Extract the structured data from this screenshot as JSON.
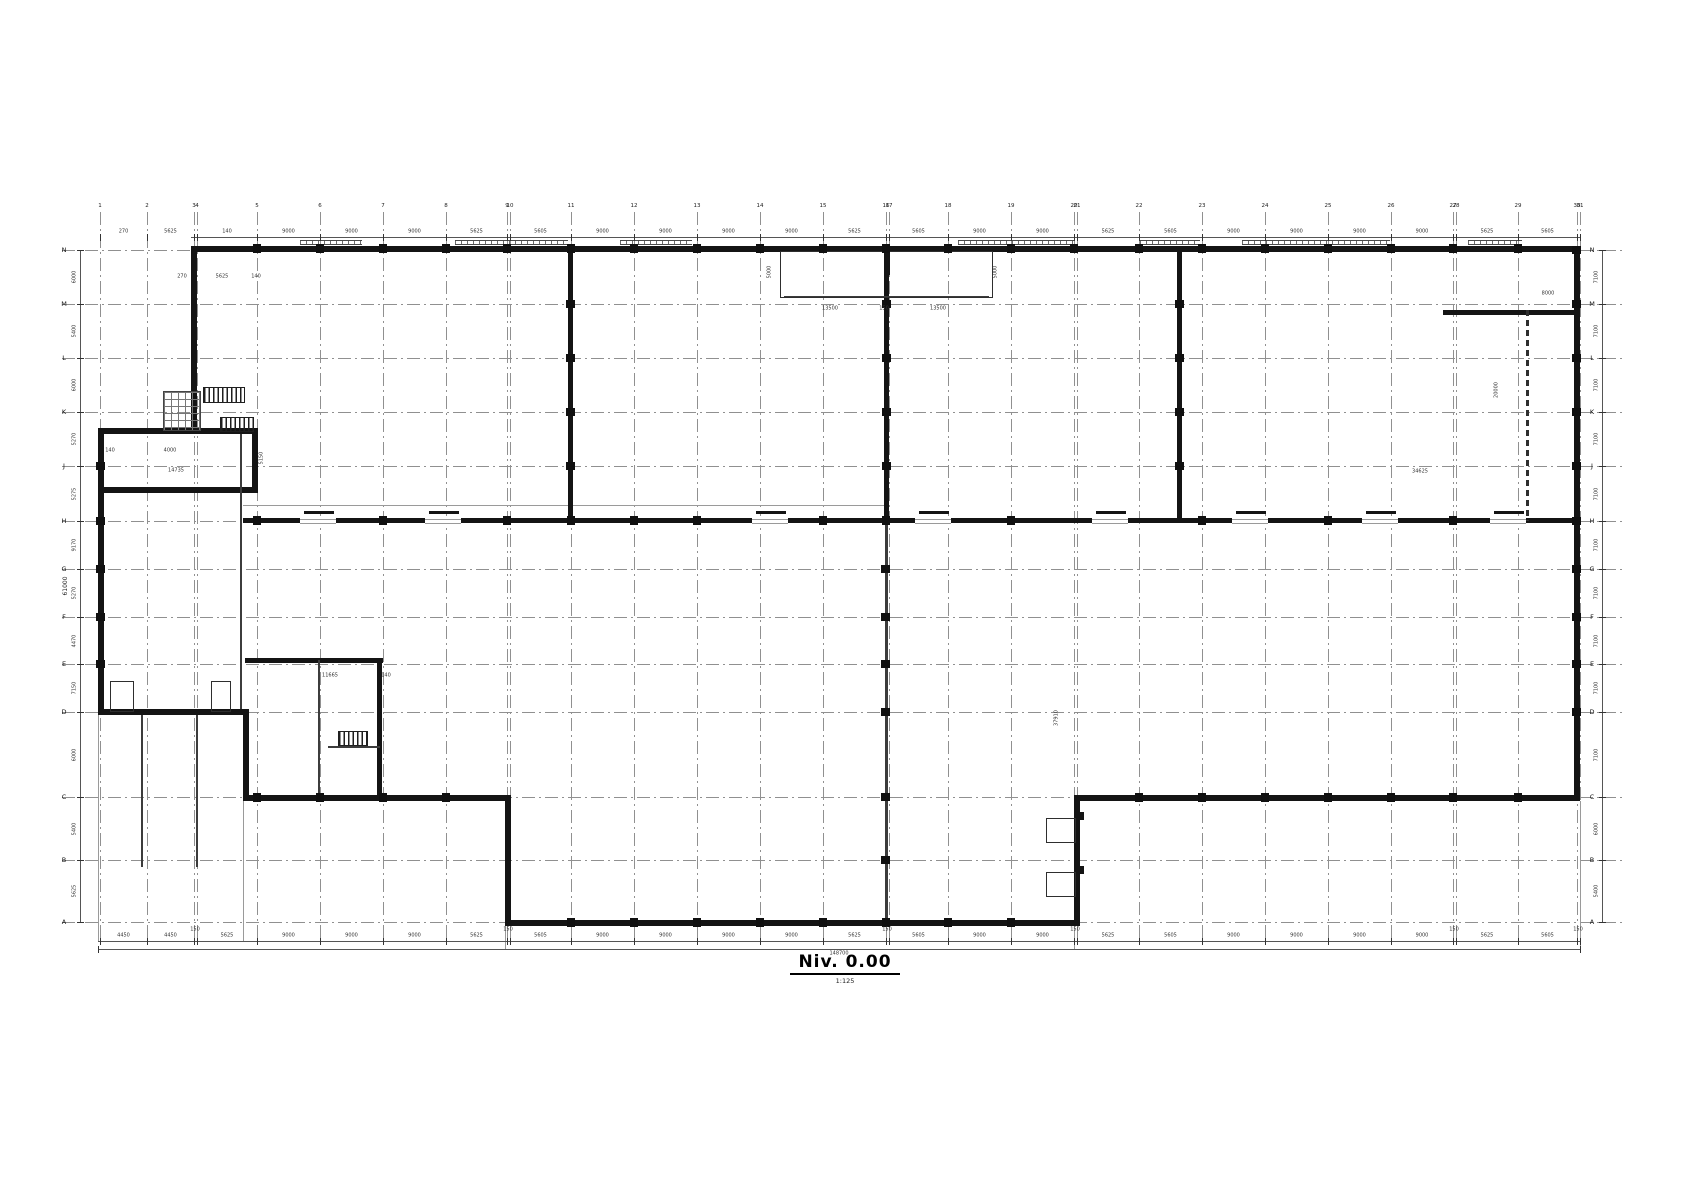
{
  "sheet": {
    "title": "Niv. 0.00",
    "scale": "1:125"
  },
  "colors": {
    "wall": "#141414",
    "grid": "#909090",
    "dim": "#2b2b2b",
    "window": "#6a6a6a"
  },
  "grid": {
    "columns": [
      {
        "label": "1",
        "x": 100
      },
      {
        "label": "2",
        "x": 147
      },
      {
        "label": "3",
        "x": 194
      },
      {
        "label": "4",
        "x": 197
      },
      {
        "label": "5",
        "x": 257
      },
      {
        "label": "6",
        "x": 320
      },
      {
        "label": "7",
        "x": 383
      },
      {
        "label": "8",
        "x": 446
      },
      {
        "label": "9",
        "x": 507
      },
      {
        "label": "10",
        "x": 510
      },
      {
        "label": "11",
        "x": 571
      },
      {
        "label": "12",
        "x": 634
      },
      {
        "label": "13",
        "x": 697
      },
      {
        "label": "14",
        "x": 760
      },
      {
        "label": "15",
        "x": 823
      },
      {
        "label": "16",
        "x": 886
      },
      {
        "label": "17",
        "x": 889
      },
      {
        "label": "18",
        "x": 948
      },
      {
        "label": "19",
        "x": 1011
      },
      {
        "label": "20",
        "x": 1074
      },
      {
        "label": "21",
        "x": 1077
      },
      {
        "label": "22",
        "x": 1139
      },
      {
        "label": "23",
        "x": 1202
      },
      {
        "label": "24",
        "x": 1265
      },
      {
        "label": "25",
        "x": 1328
      },
      {
        "label": "26",
        "x": 1391
      },
      {
        "label": "27",
        "x": 1453
      },
      {
        "label": "28",
        "x": 1456
      },
      {
        "label": "29",
        "x": 1518
      },
      {
        "label": "30",
        "x": 1577
      },
      {
        "label": "31",
        "x": 1580
      }
    ],
    "rows": [
      {
        "label": "N",
        "y": 250
      },
      {
        "label": "M",
        "y": 304
      },
      {
        "label": "L",
        "y": 358
      },
      {
        "label": "K",
        "y": 412
      },
      {
        "label": "J",
        "y": 466
      },
      {
        "label": "H",
        "y": 521
      },
      {
        "label": "G",
        "y": 569
      },
      {
        "label": "F",
        "y": 617
      },
      {
        "label": "E",
        "y": 664
      },
      {
        "label": "D",
        "y": 712
      },
      {
        "label": "C",
        "y": 797
      },
      {
        "label": "B",
        "y": 860
      },
      {
        "label": "A",
        "y": 922
      }
    ],
    "v_extent": [
      212,
      940
    ],
    "h_extent": [
      62,
      1622
    ]
  },
  "walls": [
    {
      "name": "top-wall",
      "r": [
        191,
        246,
        1389,
        6
      ]
    },
    {
      "name": "right-wall",
      "r": [
        1574,
        246,
        6,
        555
      ]
    },
    {
      "name": "bottom-right-wall",
      "r": [
        1074,
        795,
        506,
        6
      ]
    },
    {
      "name": "dock-notch-wall",
      "r": [
        1074,
        795,
        6,
        131
      ]
    },
    {
      "name": "bottom-center-wall",
      "r": [
        505,
        920,
        575,
        6
      ]
    },
    {
      "name": "left-notch-wall",
      "r": [
        505,
        795,
        6,
        131
      ]
    },
    {
      "name": "row-c-left-wall",
      "r": [
        243,
        795,
        266,
        6
      ]
    },
    {
      "name": "left-step-wall",
      "r": [
        243,
        709,
        6,
        92
      ]
    },
    {
      "name": "row-d-wall",
      "r": [
        98,
        709,
        151,
        6
      ]
    },
    {
      "name": "left-wall",
      "r": [
        98,
        428,
        6,
        287
      ]
    },
    {
      "name": "tl-room-top-wall",
      "r": [
        98,
        428,
        160,
        6
      ]
    },
    {
      "name": "tl-room-bottom-wall",
      "r": [
        98,
        487,
        160,
        6
      ]
    },
    {
      "name": "tl-room-right-wall",
      "r": [
        252,
        428,
        6,
        65
      ]
    },
    {
      "name": "top-left-wall",
      "r": [
        191,
        246,
        6,
        188
      ]
    },
    {
      "name": "main-interior-wall",
      "r": [
        243,
        518,
        1337,
        5
      ]
    },
    {
      "name": "interior-wall-v1",
      "r": [
        568,
        246,
        5,
        277
      ]
    },
    {
      "name": "interior-wall-v2",
      "r": [
        884,
        246,
        5,
        277
      ]
    },
    {
      "name": "interior-wall-v3",
      "r": [
        1177,
        246,
        5,
        277
      ]
    },
    {
      "name": "tr-room-wall",
      "r": [
        1443,
        310,
        137,
        5
      ]
    },
    {
      "name": "bl-room-wall-h",
      "r": [
        245,
        658,
        138,
        5
      ]
    },
    {
      "name": "bl-room-wall-v",
      "r": [
        377,
        658,
        5,
        142
      ]
    },
    {
      "name": "dock-block-1",
      "r": [
        1076,
        812,
        8,
        8
      ]
    },
    {
      "name": "dock-block-2",
      "r": [
        1076,
        866,
        8,
        8
      ]
    },
    {
      "name": "bay-center-post",
      "r": [
        884,
        251,
        6,
        24
      ]
    }
  ],
  "light_walls": [
    {
      "name": "interior-wall-v2-lower",
      "r": [
        885,
        523,
        3,
        403
      ]
    },
    {
      "name": "left-inner-wall",
      "r": [
        240,
        434,
        2,
        275
      ]
    },
    {
      "name": "stair-room-wall-l",
      "r": [
        318,
        660,
        2,
        140
      ]
    },
    {
      "name": "stair-room-wall-b",
      "r": [
        328,
        746,
        52,
        2
      ]
    },
    {
      "name": "ramp-line-1",
      "r": [
        141,
        715,
        2,
        152
      ]
    },
    {
      "name": "ramp-line-2",
      "r": [
        196,
        715,
        2,
        152
      ]
    },
    {
      "name": "bay-inner-line",
      "r": [
        784,
        296,
        205,
        2
      ]
    }
  ],
  "dashed_walls": [
    {
      "name": "tr-room-partition",
      "r": [
        1526,
        310,
        3,
        211
      ]
    }
  ],
  "outlines": [
    {
      "name": "loading-bay",
      "r": [
        780,
        251,
        213,
        47
      ]
    },
    {
      "name": "canopy-box-1",
      "r": [
        110,
        681,
        24,
        31
      ]
    },
    {
      "name": "canopy-box-2",
      "r": [
        211,
        681,
        20,
        31
      ]
    },
    {
      "name": "dock-leveler-1",
      "r": [
        1046,
        818,
        30,
        25
      ]
    },
    {
      "name": "dock-leveler-2",
      "r": [
        1046,
        872,
        30,
        25
      ]
    }
  ],
  "stairs": [
    {
      "name": "stair-top-left-1",
      "r": [
        203,
        387,
        42,
        16
      ]
    },
    {
      "name": "stair-top-left-2",
      "r": [
        220,
        417,
        34,
        15
      ]
    },
    {
      "name": "stair-bottom-left",
      "r": [
        338,
        731,
        30,
        15
      ]
    }
  ],
  "meshes": [
    {
      "name": "elevator-shaft",
      "r": [
        163,
        391,
        38,
        40
      ]
    }
  ],
  "windows": [
    {
      "r": [
        300,
        240,
        62,
        5
      ]
    },
    {
      "r": [
        455,
        240,
        113,
        5
      ]
    },
    {
      "r": [
        620,
        240,
        72,
        5
      ]
    },
    {
      "r": [
        958,
        240,
        117,
        5
      ]
    },
    {
      "r": [
        1140,
        240,
        60,
        5
      ]
    },
    {
      "r": [
        1242,
        240,
        148,
        5
      ]
    },
    {
      "r": [
        1468,
        240,
        54,
        5
      ]
    }
  ],
  "doors_h1": [
    300,
    425,
    752,
    915,
    1092,
    1232,
    1362,
    1490
  ],
  "thin_lines": [
    {
      "r": [
        98,
        715,
        1,
        226
      ]
    },
    {
      "r": [
        243,
        801,
        1,
        140
      ]
    },
    {
      "r": [
        505,
        926,
        1,
        23
      ]
    },
    {
      "r": [
        1074,
        926,
        1,
        23
      ]
    },
    {
      "r": [
        1580,
        801,
        1,
        148
      ]
    },
    {
      "r": [
        191,
        252,
        1,
        -1
      ]
    },
    {
      "r": [
        243,
        505,
        643,
        1
      ]
    }
  ],
  "dims": {
    "bottom": {
      "y": 941,
      "x1": 98,
      "x2": 1580,
      "values": [
        "4450",
        "4450",
        "5625",
        "9000",
        "9000",
        "9000",
        "5625",
        "5605",
        "9000",
        "9000",
        "9000",
        "9000",
        "5625",
        "5605",
        "9000",
        "9000",
        "5625",
        "5605",
        "9000",
        "9000",
        "9000",
        "9000",
        "5625",
        "5605"
      ],
      "pair_label": "150",
      "total": "148700",
      "total_y": 949
    },
    "top": {
      "y": 237,
      "x1": 191,
      "x2": 1580,
      "values": [
        "270",
        "5625",
        "140",
        "9000",
        "9000",
        "9000",
        "5625",
        "5605",
        "9000",
        "9000",
        "9000",
        "9000",
        "5625",
        "5605",
        "9000",
        "9000",
        "5625",
        "5605",
        "9000",
        "9000",
        "9000",
        "9000",
        "5625",
        "5605"
      ]
    },
    "left": {
      "x": 80,
      "y1": 250,
      "y2": 922,
      "values": [
        "6000",
        "5400",
        "6000",
        "5270",
        "5275",
        "9170",
        "5270",
        "4470",
        "7150",
        "6000",
        "5400",
        "5625"
      ],
      "total": "61000"
    },
    "right": {
      "x": 1602,
      "y1": 250,
      "y2": 922,
      "values": [
        "7100",
        "7100",
        "7100",
        "7100",
        "7100",
        "7100",
        "7100",
        "7100",
        "7100",
        "7100",
        "6000",
        "5400"
      ]
    }
  },
  "annotations": [
    {
      "t": "5000",
      "x": 770,
      "y": 272,
      "rot": true
    },
    {
      "t": "5000",
      "x": 996,
      "y": 272,
      "rot": true
    },
    {
      "t": "13500",
      "x": 830,
      "y": 309
    },
    {
      "t": "150",
      "x": 884,
      "y": 309
    },
    {
      "t": "13500",
      "x": 938,
      "y": 309
    },
    {
      "t": "270",
      "x": 182,
      "y": 277
    },
    {
      "t": "5625",
      "x": 222,
      "y": 277
    },
    {
      "t": "140",
      "x": 256,
      "y": 277
    },
    {
      "t": "4000",
      "x": 170,
      "y": 451
    },
    {
      "t": "140",
      "x": 110,
      "y": 451
    },
    {
      "t": "5150",
      "x": 262,
      "y": 458,
      "rot": true
    },
    {
      "t": "14735",
      "x": 176,
      "y": 471
    },
    {
      "t": "8000",
      "x": 1548,
      "y": 294
    },
    {
      "t": "20000",
      "x": 1497,
      "y": 390,
      "rot": true
    },
    {
      "t": "34625",
      "x": 1420,
      "y": 472
    },
    {
      "t": "11665",
      "x": 330,
      "y": 676
    },
    {
      "t": "140",
      "x": 386,
      "y": 676
    },
    {
      "t": "37910",
      "x": 1057,
      "y": 718,
      "rot": true
    }
  ]
}
